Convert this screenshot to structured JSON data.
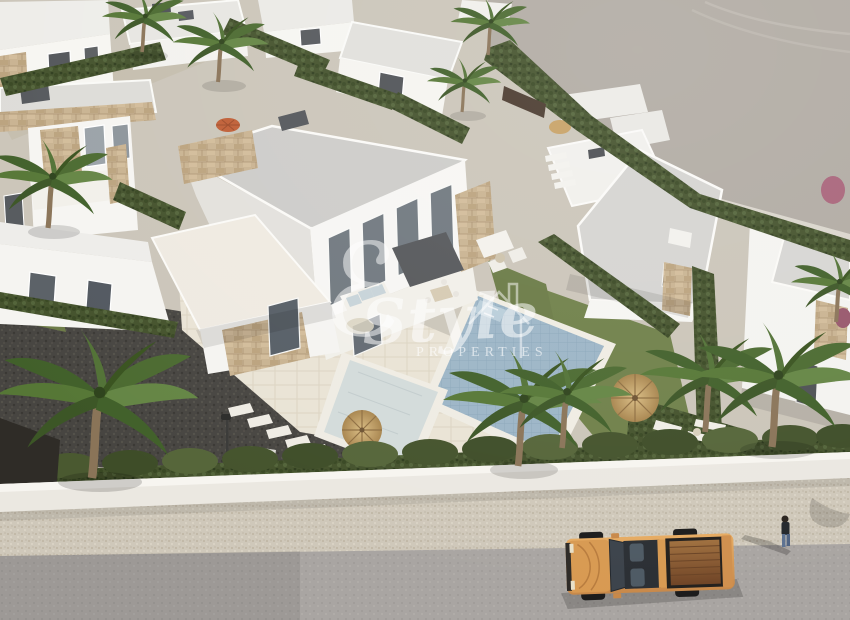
{
  "scene": {
    "alt": "Aerial 3D rendering of a development of modern white flat-roof villas with stone accents, private pools, lawns, hedged plots and palm trees; a street in the foreground with an orange pickup truck and a pedestrian on the sidewalk; empty graded land at the top right"
  },
  "watermark": {
    "initial": "ℰ",
    "wordmark": "Style",
    "subtitle": "PROPERTIES",
    "house_icon": "house-outline-icon",
    "color": "#ffffff",
    "opacity": 0.55
  },
  "palette": {
    "land_gray": "#b1aba3",
    "road_gray": "#a9a5a2",
    "sidewalk_beige": "#cfc8ba",
    "wall_white": "#ebe8e1",
    "hedge_green": "#44522c",
    "grass_green": "#6f8049",
    "gravel_dark": "#474541",
    "deck_beige": "#e9e3d5",
    "villa_white": "#f6f5f2",
    "roof_gray": "#cdccc9",
    "stone_tan": "#c9b391",
    "pool_blue": "#9cb5c6",
    "pool_pale": "#d3dbda",
    "palm_green": "#557736",
    "trunk_brown": "#8a7458",
    "umbrella_straw": "#c9a96a",
    "umbrella_orange": "#bf5e35",
    "truck_orange": "#d89a52",
    "truck_bed_brown": "#8a5a36"
  }
}
